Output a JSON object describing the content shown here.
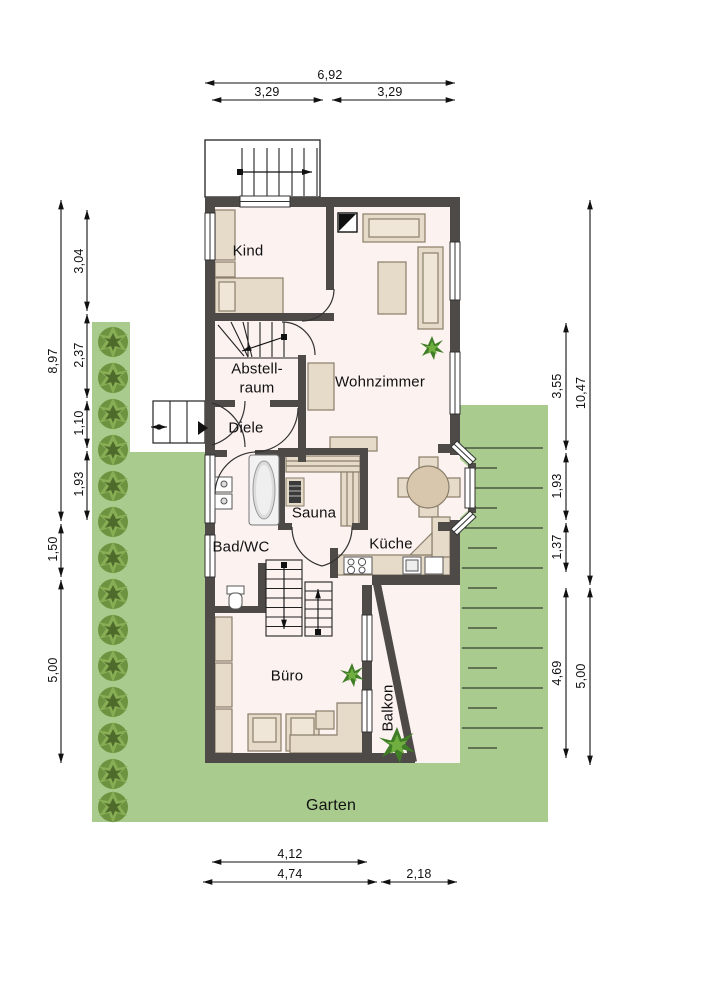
{
  "labels": {
    "kind": "Kind",
    "wohnzimmer": "Wohnzimmer",
    "abstell1": "Abstell-",
    "abstell2": "raum",
    "diele": "Diele",
    "sauna": "Sauna",
    "bad": "Bad/WC",
    "kueche": "Küche",
    "buero": "Büro",
    "balkon": "Balkon",
    "garten": "Garten"
  },
  "dims": {
    "top_total": "6,92",
    "top_left": "3,29",
    "top_right": "3,29",
    "left_outer_1": "8,97",
    "left_outer_2": "1,50",
    "left_outer_3": "5,00",
    "left_inner_1": "3,04",
    "left_inner_2": "2,37",
    "left_inner_3": "1,10",
    "left_inner_4": "1,93",
    "right_outer_1": "10,47",
    "right_outer_2": "5,00",
    "right_inner_1": "3,55",
    "right_inner_2": "1,93",
    "right_inner_3": "1,37",
    "right_inner_4": "4,69",
    "bottom_1": "4,12",
    "bottom_2": "4,74",
    "bottom_3": "2,18"
  },
  "colors": {
    "garden_green": "#a9cc8e",
    "wall_gray": "#4d4a47",
    "floor": "#fcf2f0",
    "furniture": "#e6dbc8"
  }
}
